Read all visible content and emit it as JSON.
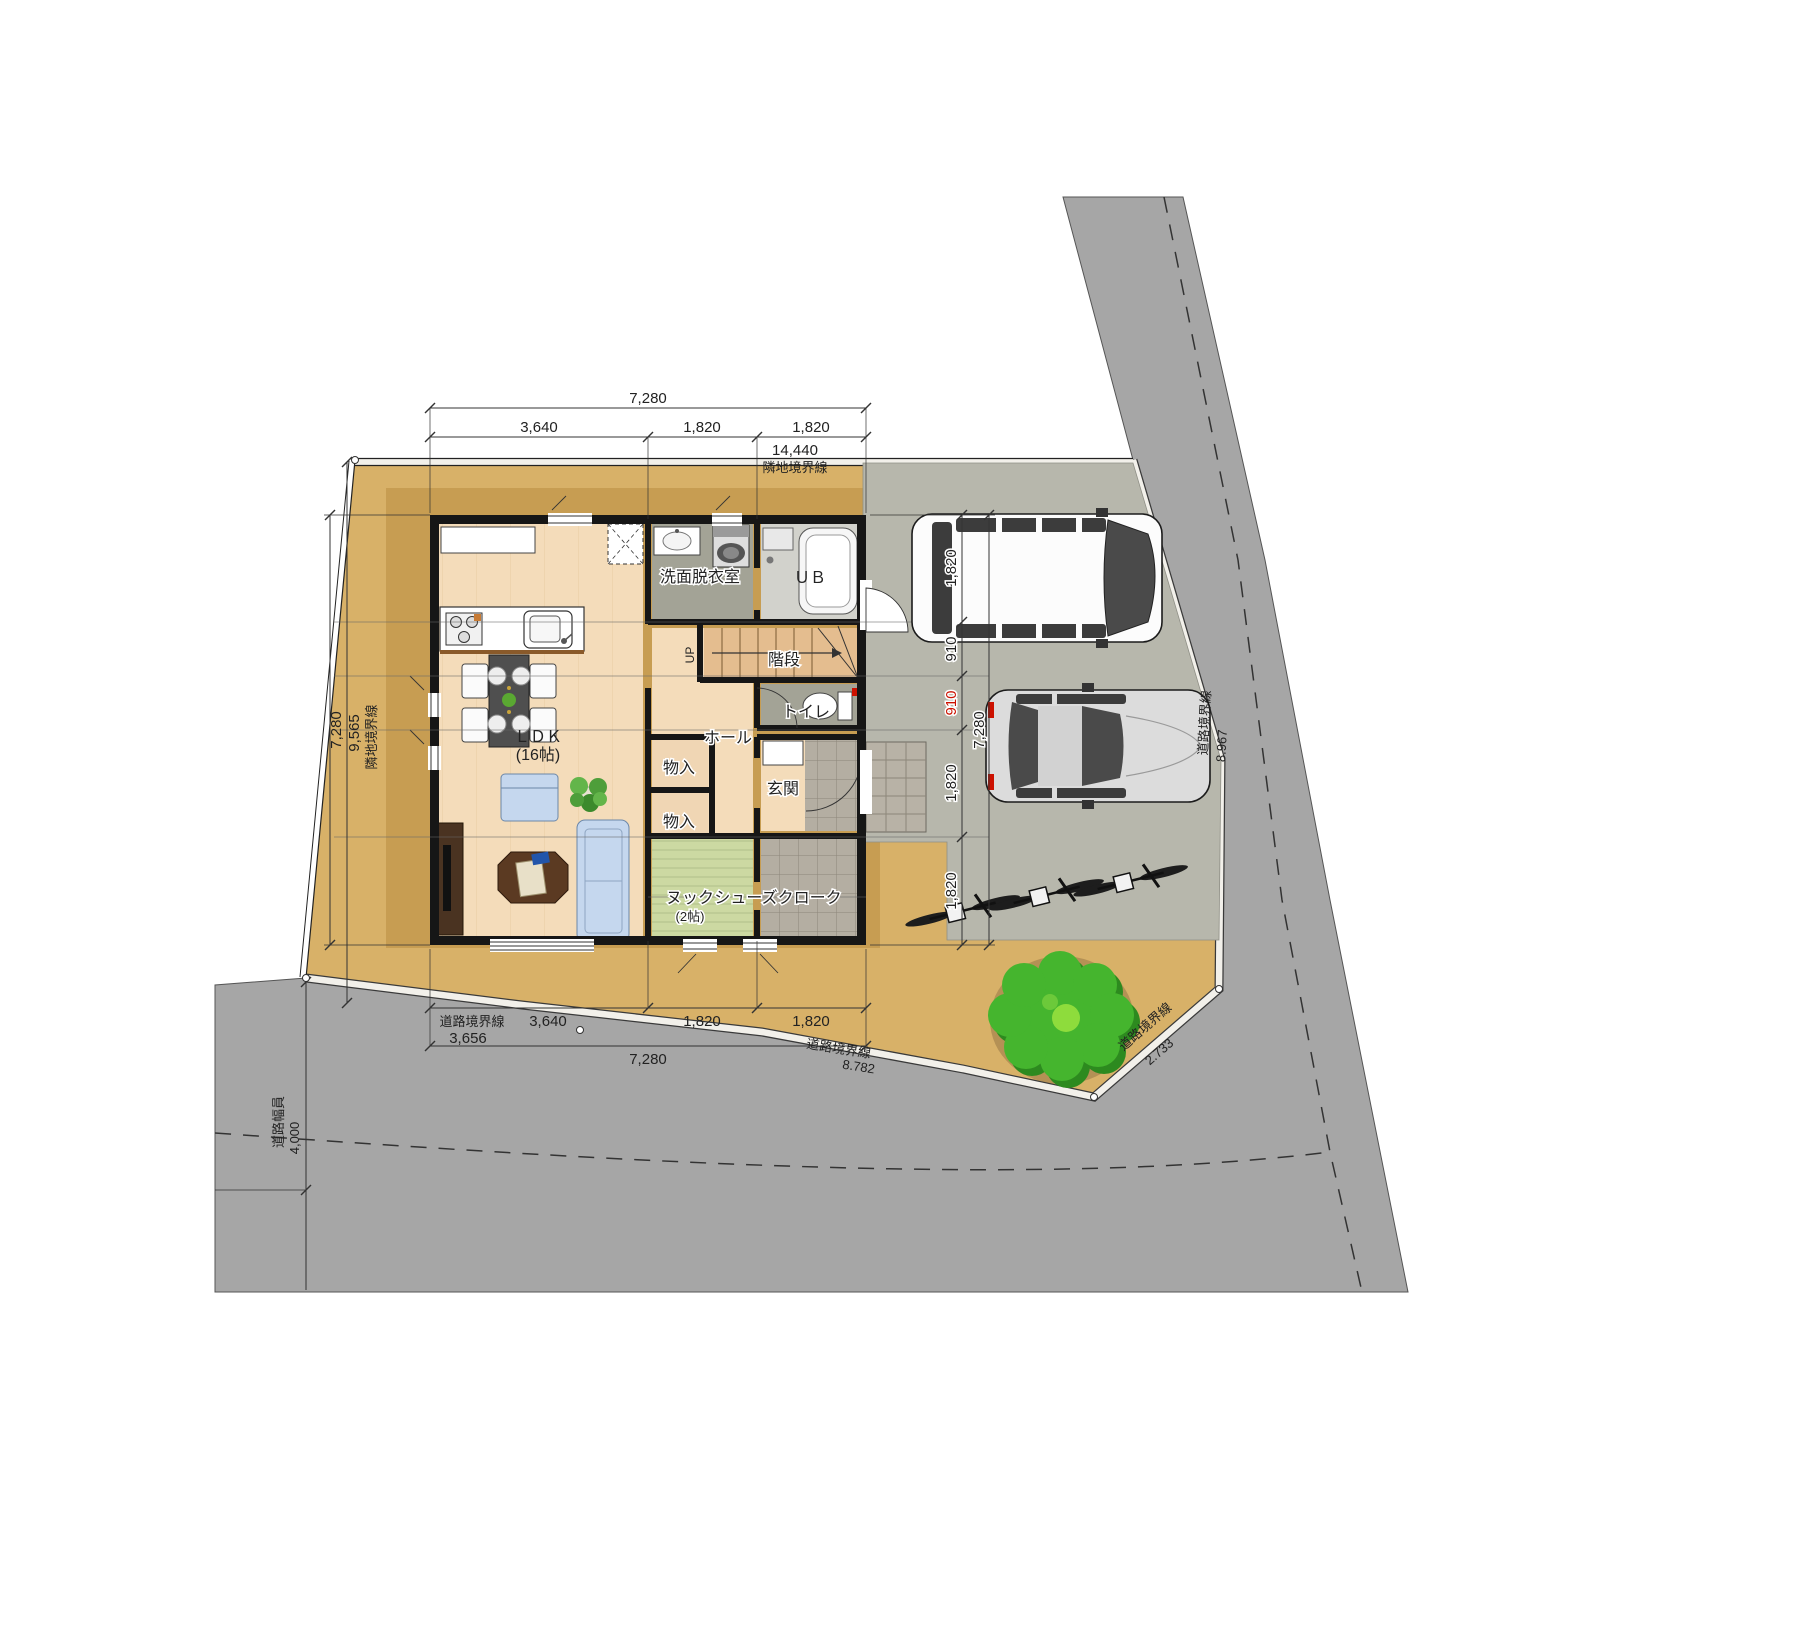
{
  "plan": {
    "rooms": {
      "ldk": "ＬＤＫ",
      "ldk_size": "(16帖)",
      "washroom": "洗面脱衣室",
      "bath": "ＵＢ",
      "stairs": "階段",
      "stairs_up": "UP",
      "toilet": "トイレ",
      "hall": "ホール",
      "storage_upper": "物入",
      "storage_lower": "物入",
      "entrance": "玄関",
      "nook": "ヌック",
      "nook_size": "(2帖)",
      "shoe_closet": "シューズクローク"
    },
    "dims": {
      "top_total": "7,280",
      "top_seg1": "3,640",
      "top_seg2": "1,820",
      "top_seg3": "1,820",
      "site_north_len": "14,440",
      "west_house": "7,280",
      "west_site": "9,565",
      "east_seg1": "1,820",
      "east_seg2": "910",
      "east_seg3": "910",
      "east_seg4": "1,820",
      "east_seg5": "1,820",
      "east_total": "7,280",
      "south_seg1": "3,640",
      "south_seg2": "1,820",
      "south_seg3": "1,820",
      "south_total": "7,280",
      "south_boundary_seg": "3,656",
      "road_width": "4,000",
      "east_road_len": "8.967",
      "south_road_len": "8.782",
      "corner_road_len": "2.733"
    },
    "boundaries": {
      "north": "隣地境界線",
      "west": "隣地境界線",
      "south": "道路境界線",
      "south2": "道路境界線",
      "east": "道路境界線",
      "corner": "道路境界線",
      "road_width_label": "道路幅員"
    },
    "colors": {
      "site": "#d8b168",
      "site_inner": "#c79d52",
      "road": "#a6a6a6",
      "parking": "#b7b7ac",
      "wood": "#f4dcba",
      "wet": "#a3a396",
      "tile": "#b4aea2",
      "tatami": "#ccd9a2",
      "tree": "#45b52e",
      "accent_red": "#cc1100"
    }
  }
}
